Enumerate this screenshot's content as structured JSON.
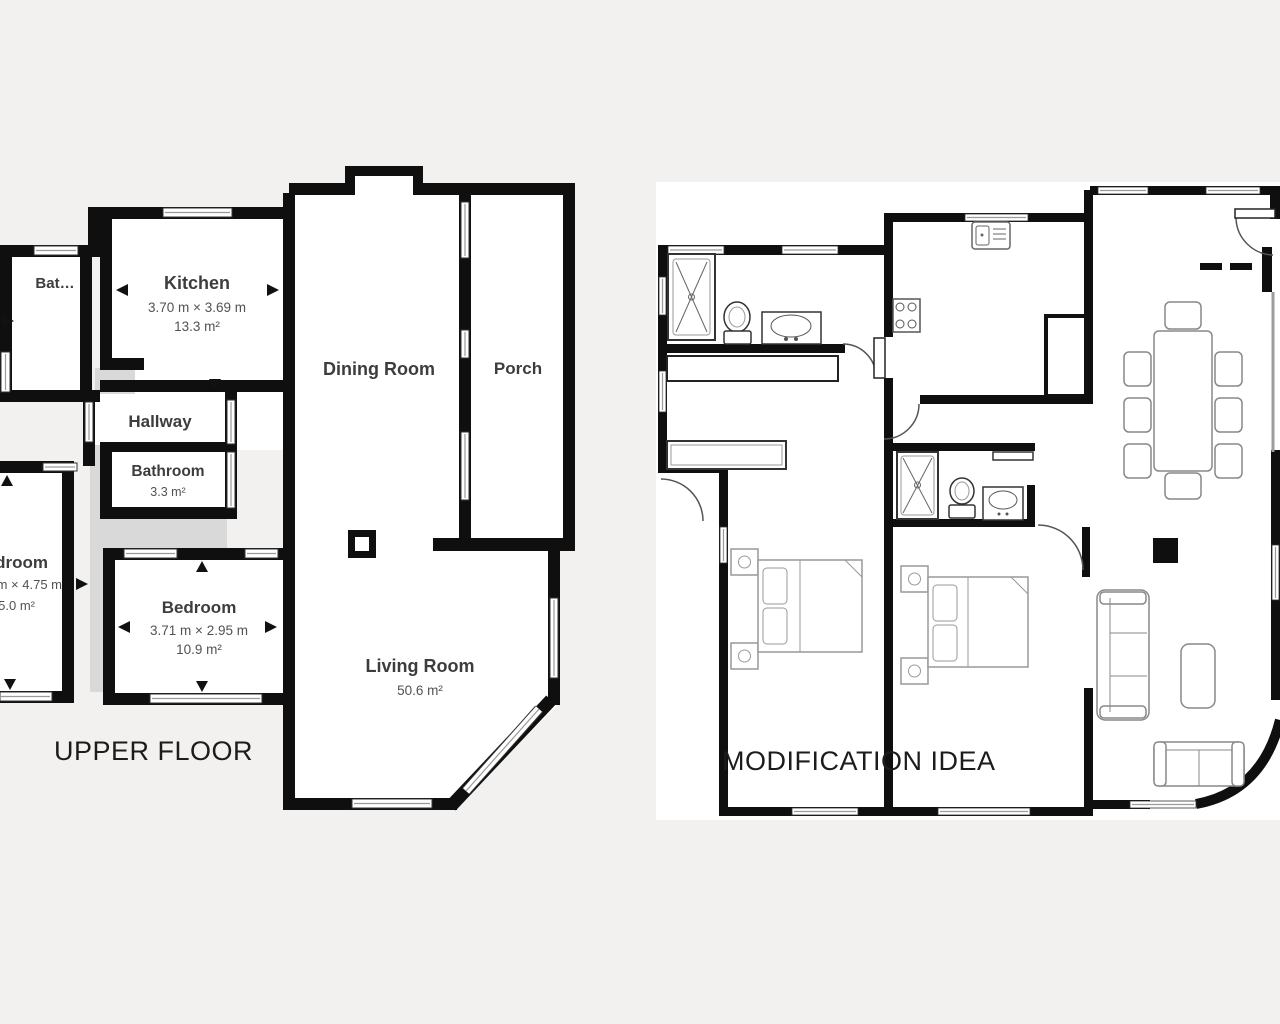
{
  "colors": {
    "background": "#f2f1ef",
    "plan_background": "#ffffff",
    "wall": "#0f0f0f",
    "room_label": "#3d3d3d",
    "dimension_text": "#525252",
    "void_gray": "#d9d9d9",
    "furniture_stroke": "#8a8a8a"
  },
  "left_plan": {
    "title": "UPPER FLOOR",
    "rooms": {
      "bathroom_small": {
        "label": "Bat…"
      },
      "kitchen": {
        "label": "Kitchen",
        "dimensions": "3.70 m × 3.69 m",
        "area": "13.3 m²"
      },
      "hallway": {
        "label": "Hallway"
      },
      "bathroom": {
        "label": "Bathroom",
        "area": "3.3 m²"
      },
      "bedroom_left_cut": {
        "label_fragment": "droom",
        "dimensions_fragment": "m × 4.75 m",
        "area_fragment": "5.0 m²"
      },
      "bedroom": {
        "label": "Bedroom",
        "dimensions": "3.71 m × 2.95 m",
        "area": "10.9 m²"
      },
      "dining_room": {
        "label": "Dining Room"
      },
      "porch": {
        "label": "Porch"
      },
      "living_room": {
        "label": "Living Room",
        "area": "50.6 m²"
      }
    }
  },
  "right_plan": {
    "title": "MODIFICATION IDEA",
    "furniture_icons": [
      "shower-icon",
      "toilet-icon",
      "sink-vanity-icon",
      "stove-icon",
      "washer-icon",
      "dining-table-icon",
      "chair-icon",
      "double-bed-icon",
      "nightstand-icon",
      "sofa-icon",
      "loveseat-icon",
      "coffee-table-icon",
      "wardrobe-icon",
      "door-swing-icon",
      "window-icon",
      "column-icon"
    ]
  }
}
